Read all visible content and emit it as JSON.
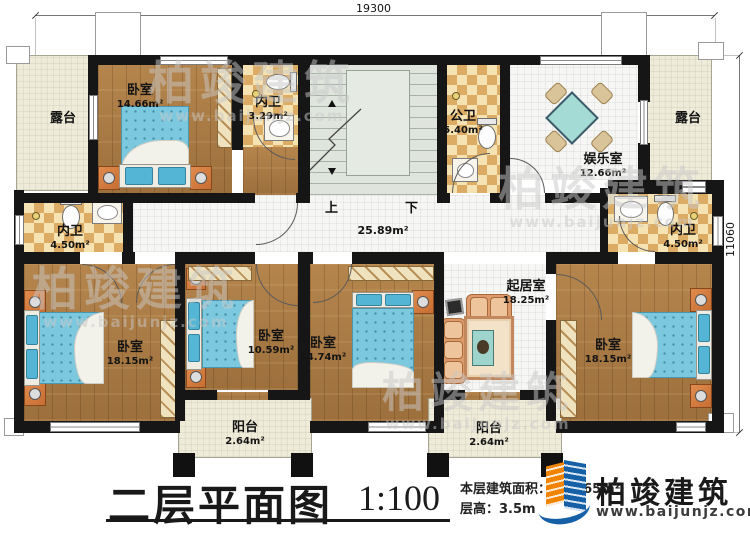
{
  "dimensions": {
    "top": "19300",
    "right": "11060"
  },
  "rooms": {
    "terrace_left": {
      "name": "露台"
    },
    "terrace_right": {
      "name": "露台"
    },
    "bedroom_top": {
      "name": "卧室",
      "area": "14.66m²"
    },
    "bath_top": {
      "name": "内卫",
      "area": "3.29m²"
    },
    "public_bath": {
      "name": "公卫",
      "area": "5.40m²"
    },
    "entertainment": {
      "name": "娱乐室",
      "area": "12.66m²"
    },
    "bath_left": {
      "name": "内卫",
      "area": "4.50m²"
    },
    "bath_right": {
      "name": "内卫",
      "area": "4.50m²"
    },
    "hall": {
      "area": "25.89m²"
    },
    "bedroom_bottom_left": {
      "name": "卧室",
      "area": "18.15m²"
    },
    "bedroom_small": {
      "name": "卧室",
      "area": "10.59m²"
    },
    "bedroom_mid": {
      "name": "卧室",
      "area": "14.74m²"
    },
    "living": {
      "name": "起居室",
      "area": "18.25m²"
    },
    "bedroom_bottom_right": {
      "name": "卧室",
      "area": "18.15m²"
    },
    "balcony_left": {
      "name": "阳台",
      "area": "2.64m²"
    },
    "balcony_right": {
      "name": "阳台",
      "area": "2.64m²"
    }
  },
  "stairs": {
    "up": "上",
    "down": "下"
  },
  "title": {
    "text": "二层平面图",
    "scale": "1:100",
    "area_line": "本层建筑面积：179.65m²",
    "floor_height_line": "层高：3.5m"
  },
  "logo": {
    "company": "柏竣建筑",
    "website": "www.baijunjz.com"
  },
  "watermark": {
    "text": "柏竣建筑",
    "url": "www.baijunjz.com"
  },
  "colors": {
    "wall": "#161616",
    "wood": "#a97c44",
    "checker": "#dcab64",
    "bed": "#7cc8de",
    "brand_blue": "#1660a8",
    "brand_orange": "#f08300"
  }
}
